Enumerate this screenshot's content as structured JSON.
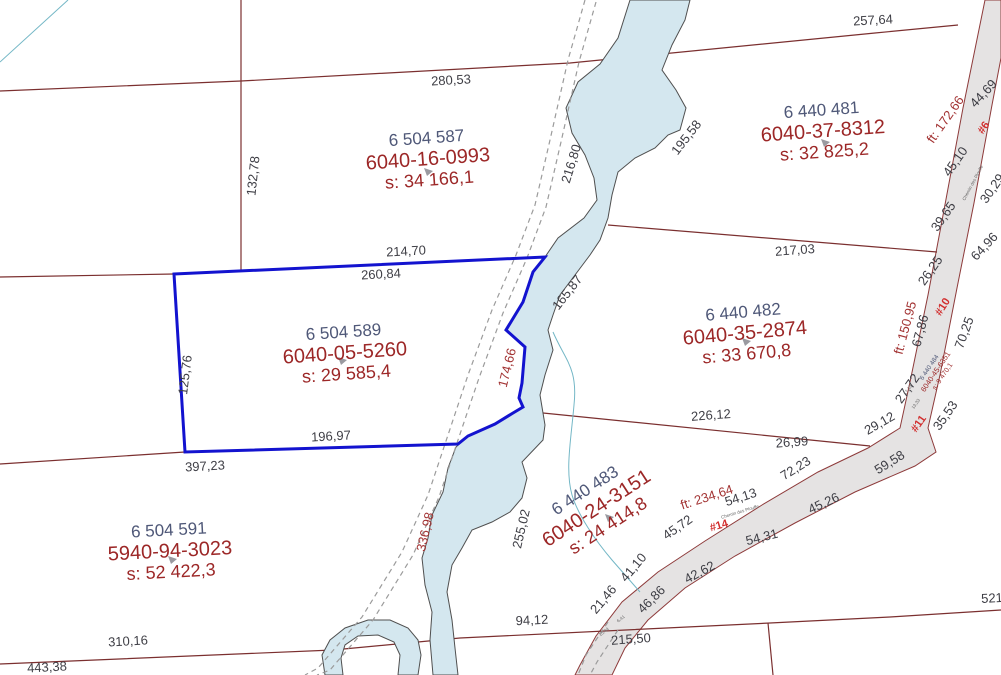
{
  "colors": {
    "background": "#ffffff",
    "boundary": "#7b2f2f",
    "selected": "#1313cf",
    "stream_fill": "#d4e7ef",
    "stream_stroke": "#4f4f4f",
    "road_fill": "#e5e3e3",
    "road_stroke": "#8d3a3a",
    "trail": "#9b9b9b",
    "creek": "#74b7c6",
    "lot_text": "#4f5878",
    "matricule_text": "#9c2727",
    "dim_gray": "#3e3e45",
    "dim_red": "#a33434",
    "road_tag": "#d22f2f",
    "centroid": "#9a9aa0"
  },
  "map": {
    "parcels": [
      {
        "lot": "6 504 587",
        "matricule": "6040-16-0993",
        "area": "s: 34 166,1",
        "cx": 428,
        "cy": 160,
        "r": -4,
        "marker": [
          424,
          168
        ]
      },
      {
        "lot": "6 440 481",
        "matricule": "6040-37-8312",
        "area": "s: 32 825,2",
        "cx": 823,
        "cy": 132,
        "r": -4,
        "marker": [
          821,
          139
        ]
      },
      {
        "lot": "6 504 589",
        "matricule": "6040-05-5260",
        "area": "s: 29 585,4",
        "cx": 345,
        "cy": 354,
        "r": -4,
        "marker": [
          338,
          357
        ],
        "selected": true
      },
      {
        "lot": "6 440 482",
        "matricule": "6040-35-2874",
        "area": "s: 33 670,8",
        "cx": 745,
        "cy": 334,
        "r": -5,
        "marker": [
          742,
          338
        ]
      },
      {
        "lot": "6 440 483",
        "matricule": "6040-24-3151",
        "area": "s: 24 414,8",
        "cx": 597,
        "cy": 509,
        "r": -33,
        "marker": [
          605,
          514
        ]
      },
      {
        "lot": "6 504 591",
        "matricule": "5940-94-3023",
        "area": "s: 52 422,3",
        "cx": 170,
        "cy": 552,
        "r": -3,
        "marker": [
          168,
          556
        ]
      },
      {
        "lot": "6 440 484",
        "matricule": "6040-45-6351",
        "area": "s: 9 470,1",
        "cx": 936,
        "cy": 372,
        "r": -56,
        "small": true
      }
    ],
    "labels": [
      {
        "t": "257,64",
        "x": 873,
        "y": 21,
        "r": -3
      },
      {
        "t": "280,53",
        "x": 451,
        "y": 81,
        "r": -3
      },
      {
        "t": "132,78",
        "x": 254,
        "y": 176,
        "r": -84
      },
      {
        "t": "216,80",
        "x": 572,
        "y": 164,
        "r": -73
      },
      {
        "t": "195,58",
        "x": 687,
        "y": 138,
        "r": -52
      },
      {
        "t": "214,70",
        "x": 406,
        "y": 252,
        "r": -3
      },
      {
        "t": "260,84",
        "x": 381,
        "y": 275,
        "r": -3
      },
      {
        "t": "165,87",
        "x": 568,
        "y": 293,
        "r": -52
      },
      {
        "t": "174,66",
        "x": 508,
        "y": 368,
        "r": -76,
        "c": "red"
      },
      {
        "t": "125,76",
        "x": 186,
        "y": 375,
        "r": -83
      },
      {
        "t": "196,97",
        "x": 331,
        "y": 437,
        "r": -3
      },
      {
        "t": "397,23",
        "x": 205,
        "y": 467,
        "r": -3
      },
      {
        "t": "217,03",
        "x": 795,
        "y": 251,
        "r": -4
      },
      {
        "t": "226,12",
        "x": 711,
        "y": 416,
        "r": -4
      },
      {
        "t": "26,99",
        "x": 792,
        "y": 443,
        "r": -4
      },
      {
        "t": "29,12",
        "x": 880,
        "y": 424,
        "r": -30
      },
      {
        "t": "72,23",
        "x": 796,
        "y": 469,
        "r": -32
      },
      {
        "t": "59,58",
        "x": 890,
        "y": 463,
        "r": -32
      },
      {
        "t": "45,26",
        "x": 824,
        "y": 504,
        "r": -25
      },
      {
        "t": "54,13",
        "x": 741,
        "y": 498,
        "r": -18
      },
      {
        "t": "ft: 234,64",
        "x": 707,
        "y": 498,
        "r": -18,
        "c": "red"
      },
      {
        "t": "54,31",
        "x": 762,
        "y": 538,
        "r": -14
      },
      {
        "t": "42,62",
        "x": 700,
        "y": 573,
        "r": -28
      },
      {
        "t": "46,86",
        "x": 652,
        "y": 600,
        "r": -45
      },
      {
        "t": "45,72",
        "x": 678,
        "y": 528,
        "r": -35
      },
      {
        "t": "41,10",
        "x": 634,
        "y": 568,
        "r": -50
      },
      {
        "t": "21,46",
        "x": 604,
        "y": 600,
        "r": -50
      },
      {
        "t": "215,50",
        "x": 631,
        "y": 640,
        "r": -4
      },
      {
        "t": "94,12",
        "x": 532,
        "y": 621,
        "r": -3
      },
      {
        "t": "255,02",
        "x": 522,
        "y": 529,
        "r": -77
      },
      {
        "t": "336,98",
        "x": 426,
        "y": 532,
        "r": -77,
        "c": "red"
      },
      {
        "t": "310,16",
        "x": 128,
        "y": 642,
        "r": -3
      },
      {
        "t": "443,38",
        "x": 47,
        "y": 668,
        "r": -3
      },
      {
        "t": "521",
        "x": 992,
        "y": 599,
        "r": -3
      },
      {
        "t": "44,69",
        "x": 984,
        "y": 94,
        "r": -47
      },
      {
        "t": "ft: 172,66",
        "x": 946,
        "y": 120,
        "r": -55,
        "c": "red"
      },
      {
        "t": "45,10",
        "x": 956,
        "y": 162,
        "r": -55
      },
      {
        "t": "30,29",
        "x": 993,
        "y": 189,
        "r": -55
      },
      {
        "t": "39,65",
        "x": 944,
        "y": 217,
        "r": -55
      },
      {
        "t": "64,96",
        "x": 985,
        "y": 247,
        "r": -47
      },
      {
        "t": "26,25",
        "x": 931,
        "y": 271,
        "r": -55
      },
      {
        "t": "ft: 150,95",
        "x": 906,
        "y": 328,
        "r": -75,
        "c": "red"
      },
      {
        "t": "67,86",
        "x": 921,
        "y": 331,
        "r": -75
      },
      {
        "t": "70,25",
        "x": 965,
        "y": 333,
        "r": -70
      },
      {
        "t": "27,72",
        "x": 908,
        "y": 389,
        "r": -55
      },
      {
        "t": "35,53",
        "x": 946,
        "y": 416,
        "r": -55
      },
      {
        "t": "#6",
        "x": 984,
        "y": 128,
        "r": -55,
        "c": "tag",
        "n": "road-number-label"
      },
      {
        "t": "#10",
        "x": 943,
        "y": 307,
        "r": -58,
        "c": "tag",
        "n": "road-number-label"
      },
      {
        "t": "#11",
        "x": 919,
        "y": 424,
        "r": -55,
        "c": "tag",
        "n": "road-number-label"
      },
      {
        "t": "#14",
        "x": 719,
        "y": 526,
        "r": -16,
        "c": "tag",
        "n": "road-number-label"
      },
      {
        "t": "Chemin des Plouffe",
        "x": 973,
        "y": 183,
        "r": -62,
        "c": "tiny",
        "n": "street-name-label"
      },
      {
        "t": "Chemin des Plouffe",
        "x": 740,
        "y": 512,
        "r": -17,
        "c": "tiny",
        "n": "street-name-label"
      },
      {
        "t": "17,13",
        "x": 908,
        "y": 390,
        "r": -55,
        "c": "tiny"
      },
      {
        "t": "13,33",
        "x": 916,
        "y": 404,
        "r": -55,
        "c": "tiny"
      },
      {
        "t": "15,44",
        "x": 604,
        "y": 632,
        "r": -38,
        "c": "tiny"
      },
      {
        "t": "6,41",
        "x": 621,
        "y": 619,
        "r": -38,
        "c": "tiny"
      }
    ]
  }
}
